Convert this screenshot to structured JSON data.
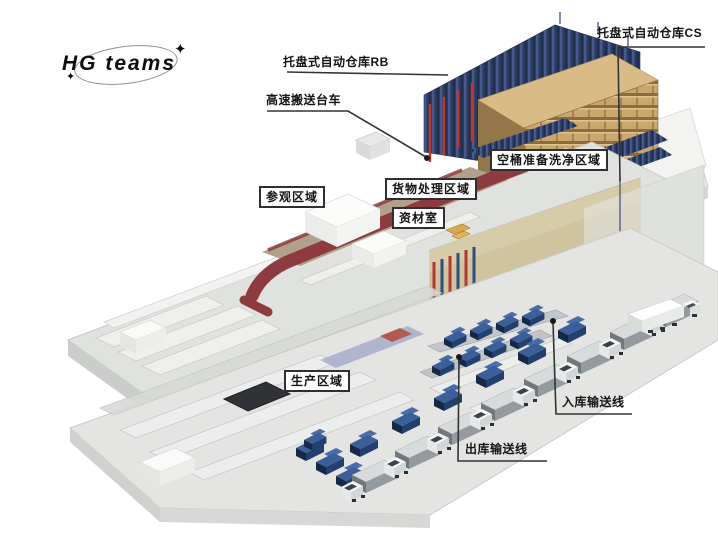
{
  "logo": {
    "text": "HG teams",
    "sparkle_icon": "✦"
  },
  "annotations": {
    "rb": "托盘式自动仓库RB",
    "cs": "托盘式自动仓库CS",
    "cart": "高速搬送台车",
    "wash": "空桶准备洗净区域",
    "cargo": "货物处理区域",
    "material": "资材室",
    "visit": "参观区域",
    "production": "生产区域",
    "inbound": "入库输送线",
    "outbound": "出库输送线"
  },
  "palette": {
    "background": "#ffffff",
    "rack_navy": "#2c3a5e",
    "rack_navy_light": "#465a8c",
    "pallet_tan": "#c9a76d",
    "pallet_tan_dark": "#8a6c3e",
    "walkway_maroon": "#8d3a40",
    "visit_floor_tan": "#b1a08b",
    "floor_gray": "#e2e3e1",
    "wall_gray": "#cbcdcb",
    "steel_red": "#c0392b",
    "conveyor_blue": "#3c5f9a",
    "truck_gray": "#949a9e",
    "leader_line": "#333333",
    "label_border": "#2f2f2f"
  }
}
